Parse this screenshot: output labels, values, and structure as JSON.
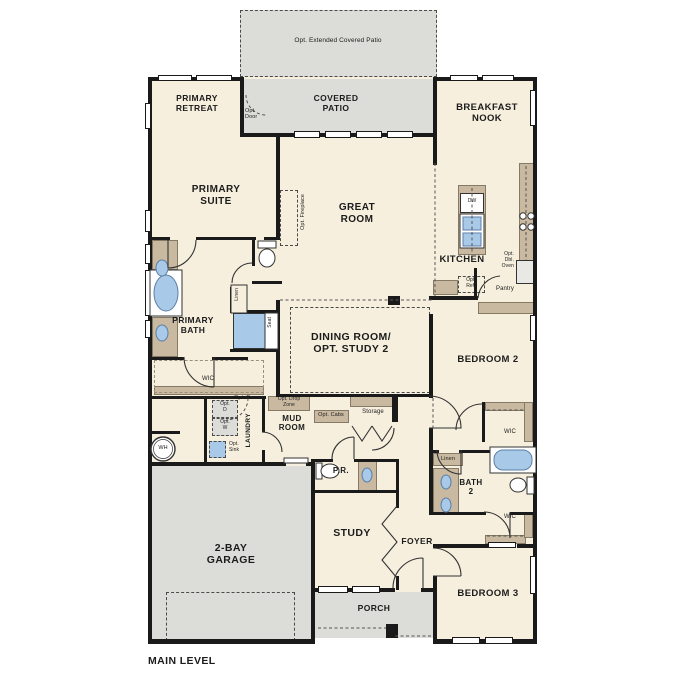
{
  "plan": {
    "level_label": "MAIN LEVEL"
  },
  "colors": {
    "floor": "#f6efde",
    "outdoor": "#dcdcd8",
    "cabinet": "#c9b9a0",
    "fixture_blue": "#a9c9e9",
    "wall": "#1a1a1a"
  },
  "labels": {
    "opt_extended_patio": "Opt. Extended Covered Patio",
    "covered_patio": "COVERED\nPATIO",
    "opt_door_patio": "Opt.\nDoor",
    "primary_retreat": "PRIMARY\nRETREAT",
    "breakfast_nook": "BREAKFAST\nNOOK",
    "primary_suite": "PRIMARY\nSUITE",
    "great_room": "GREAT\nROOM",
    "opt_fireplace": "Opt. Fireplace",
    "kitchen": "KITCHEN",
    "dw": "DW",
    "opt_dbl_oven": "Opt.\nDbl.\nOven",
    "opt_ref": "Opt.\nRef.",
    "pantry": "Pantry",
    "primary_bath": "PRIMARY\nBATH",
    "linen_primary": "Linen",
    "seat": "Seat",
    "wic_primary": "WIC",
    "dining_room": "DINING ROOM/\nOPT. STUDY 2",
    "bedroom_2": "BEDROOM 2",
    "opt_door_laundry": "Opt. Door",
    "opt_dryer": "Opt.\nD",
    "opt_washer": "Opt.\nW",
    "laundry": "LAUNDRY",
    "opt_sink": "Opt.\nSink",
    "water_heater": "WH",
    "opt_drop_zone": "Opt. Drop\nZone",
    "mud_room": "MUD\nROOM",
    "opt_cabs": "Opt. Cabs",
    "storage": "Storage",
    "garage": "2-BAY\nGARAGE",
    "powder_room": "P.R.",
    "study": "STUDY",
    "foyer": "FOYER",
    "linen_2": "Linen",
    "bath_2": "BATH\n2",
    "wic_bedroom2": "WIC",
    "wic_bedroom3": "WIC",
    "bedroom_3": "BEDROOM 3",
    "porch": "PORCH",
    "main_level": "MAIN LEVEL"
  }
}
